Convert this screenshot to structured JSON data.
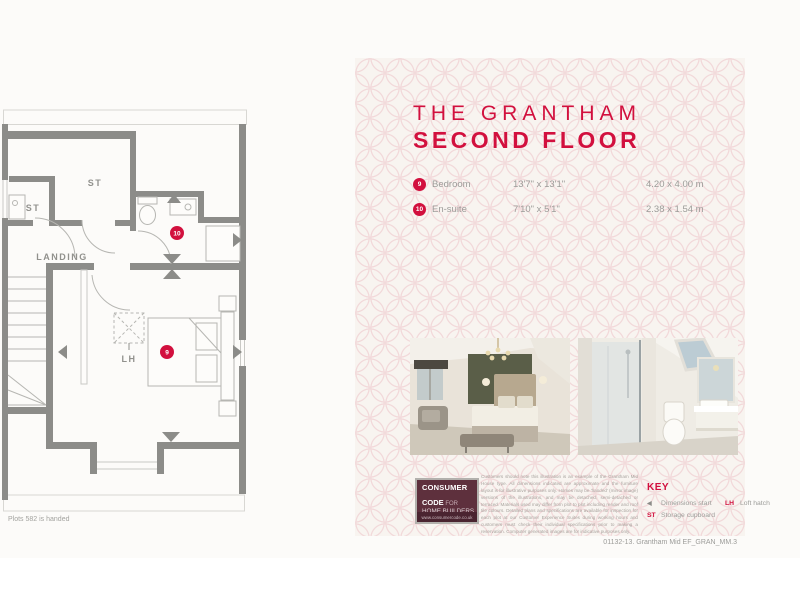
{
  "page": {
    "plots_note": "Plots 582 is handed",
    "footer_ref": "01132-13. Grantham Mid EF_GRAN_MM.3"
  },
  "titles": {
    "line1": "THE GRANTHAM",
    "line2": "SECOND FLOOR"
  },
  "rooms": [
    {
      "number": "9",
      "name": "Bedroom",
      "imperial": "13'7\" x 13'1\"",
      "metric": "4.20 x 4.00 m"
    },
    {
      "number": "10",
      "name": "En-suite",
      "imperial": "7'10\" x 5'1\"",
      "metric": "2.38 x 1.54 m"
    }
  ],
  "plan": {
    "st_top": "ST",
    "st_left": "ST",
    "landing": "LANDING",
    "loft_hatch": "LH",
    "badge_bedroom": "9",
    "badge_ensuite": "10"
  },
  "logo": {
    "line1": "CONSUMER",
    "line2_strong": "CODE",
    "line2_light": " FOR",
    "line3": "HOME BUILDERS",
    "url": "www.consumercode.co.uk"
  },
  "disclaimer": "Customers should note this illustration is an example of the Grantham Mid House type. All dimensions indicated are approximate and the furniture layout is for illustrative purposes only. Homes may be 'handed' (mirror image) versions of the illustrations, and may be detached, semi-detached or terraced. Materials used may differ from plot to plot including render and roof tile colours. Detailed plans and specifications are available for inspection for each plot at our Customer Experience Suites during working hours and customers must check their individual specifications prior to making a reservation. Computer generated images are for indicative purposes only.",
  "key": {
    "heading": "KEY",
    "items": [
      {
        "symbol": "◀",
        "label": "Dimensions start"
      },
      {
        "symbol": "LH",
        "label": "Loft hatch"
      },
      {
        "symbol": "ST",
        "label": "Storage cupboard"
      }
    ]
  },
  "colors": {
    "accent": "#d2103e",
    "wall_grey": "#8c8c89",
    "pattern_pink": "#f2d9da",
    "panel_bg": "#f8f4f0",
    "logo_maroon": "#5e303d"
  }
}
